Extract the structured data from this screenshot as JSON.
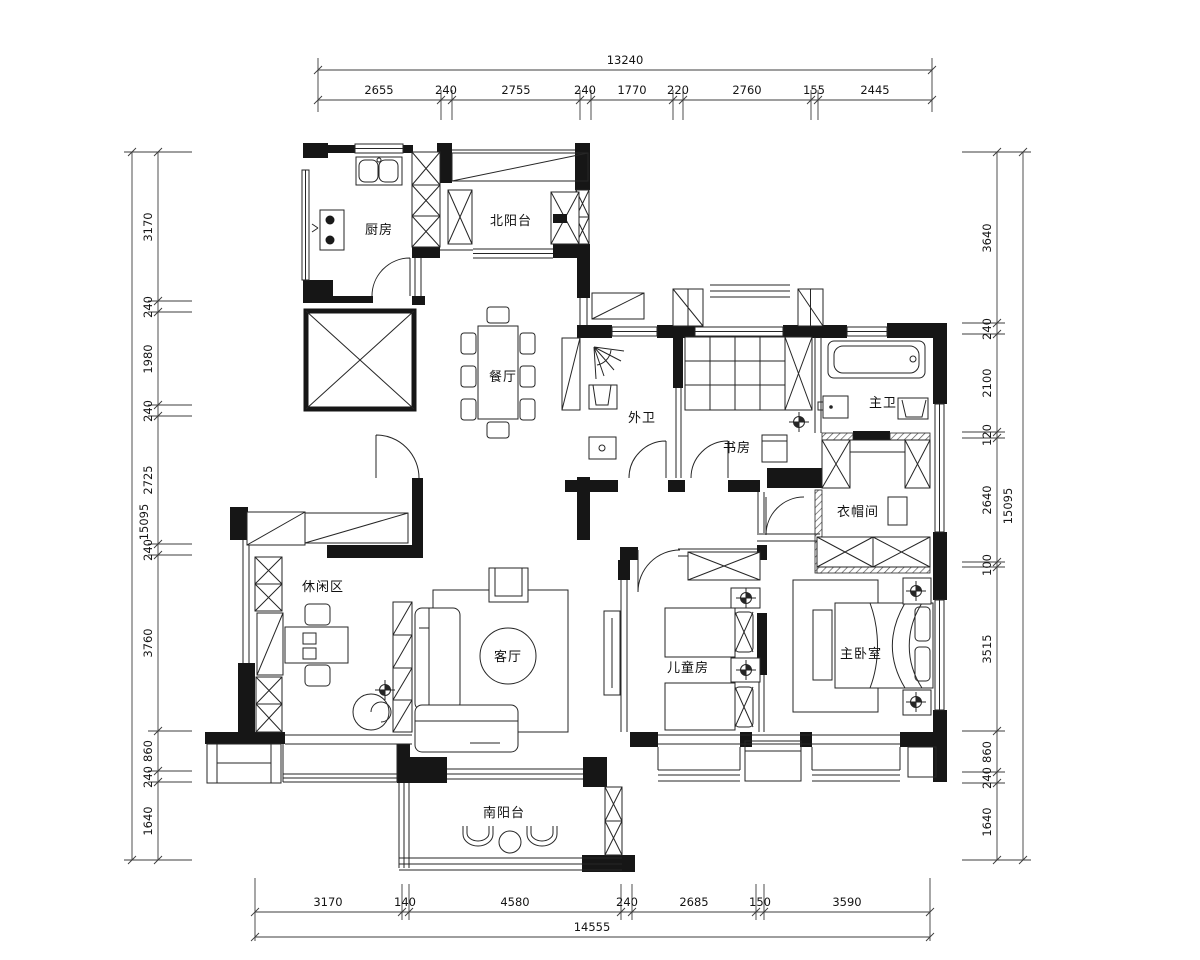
{
  "drawing": {
    "type": "apartment-floor-plan",
    "units": "mm",
    "line_color": "#262626",
    "wall_color": "#161616",
    "background": "#ffffff"
  },
  "rooms": {
    "kitchen": "厨房",
    "north_balcony": "北阳台",
    "dining": "餐厅",
    "guest_bath": "外卫",
    "study": "书房",
    "master_bath": "主卫",
    "cloakroom": "衣帽间",
    "leisure": "休闲区",
    "living": "客厅",
    "children": "儿童房",
    "master_bedroom": "主卧室",
    "south_balcony": "南阳台"
  },
  "dimensions": {
    "top": {
      "total": "13240",
      "segments": [
        "2655",
        "240",
        "2755",
        "240",
        "1770",
        "220",
        "2760",
        "155",
        "2445"
      ]
    },
    "left": {
      "total": "15095",
      "segments": [
        "3170",
        "240",
        "1980",
        "240",
        "2725",
        "240",
        "3760",
        "860",
        "240",
        "1640"
      ]
    },
    "right": {
      "total": "15095",
      "segments": [
        "3640",
        "240",
        "2100",
        "120",
        "2640",
        "100",
        "3515",
        "860",
        "240",
        "1640"
      ]
    },
    "bottom": {
      "total": "14555",
      "segments": [
        "3170",
        "140",
        "4580",
        "240",
        "2685",
        "150",
        "3590"
      ]
    }
  }
}
